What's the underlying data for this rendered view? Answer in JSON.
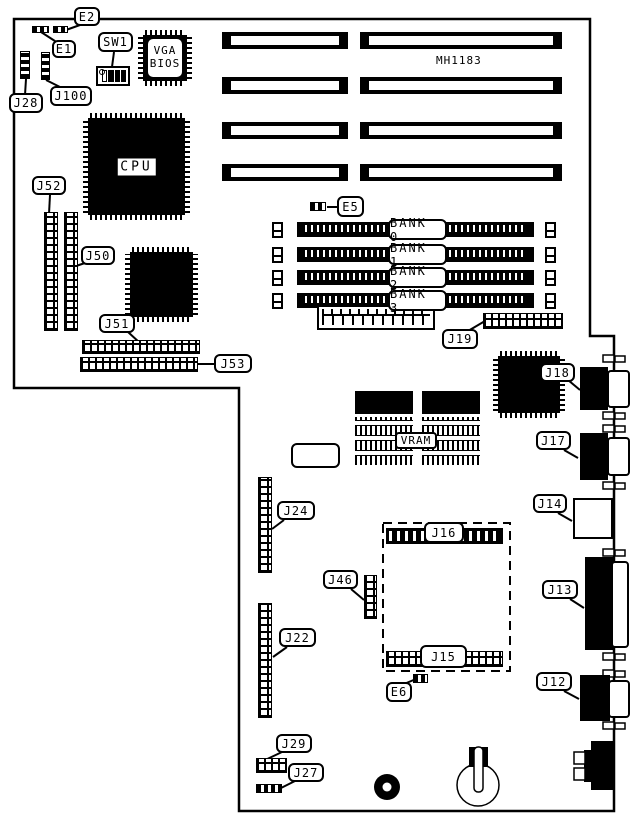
{
  "diagram": {
    "part_number": "MH1183",
    "chips": {
      "cpu": "CPU",
      "vga_line1": "VGA",
      "vga_line2": "BIOS",
      "vram": "VRAM"
    },
    "memory_banks": [
      "BANK 0",
      "BANK 1",
      "BANK 2",
      "BANK 3"
    ],
    "labels": {
      "e1": "E1",
      "e2": "E2",
      "e5": "E5",
      "e6": "E6",
      "sw1": "SW1",
      "j12": "J12",
      "j13": "J13",
      "j14": "J14",
      "j15": "J15",
      "j16": "J16",
      "j17": "J17",
      "j18": "J18",
      "j19": "J19",
      "j22": "J22",
      "j24": "J24",
      "j27": "J27",
      "j28": "J28",
      "j29": "J29",
      "j46": "J46",
      "j50": "J50",
      "j51": "J51",
      "j52": "J52",
      "j53": "J53",
      "j100": "J100"
    }
  }
}
